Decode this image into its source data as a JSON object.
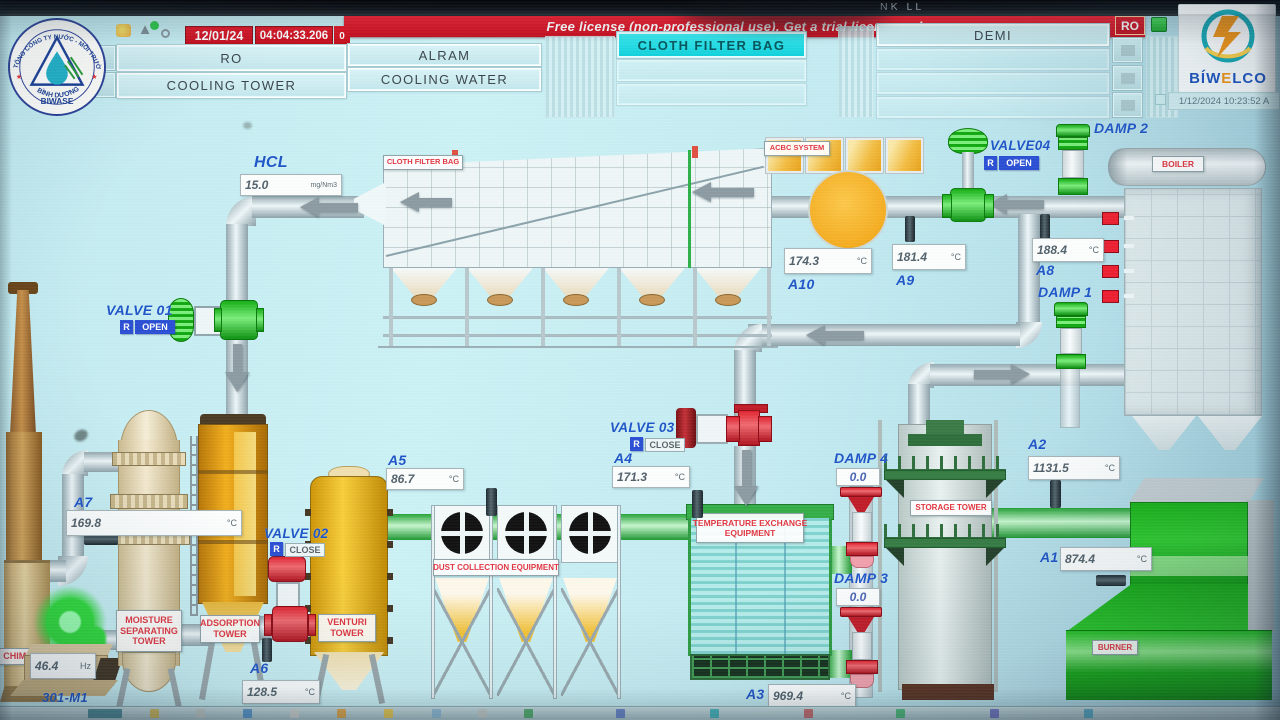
{
  "header": {
    "date": "12/01/24",
    "time": "04:04:33.206",
    "alarm_count": "0",
    "license": "Free license (non-professional use). Get a trial license or buy",
    "ro_chip": "RO",
    "bezel_text": "NK LL",
    "buttons": {
      "ro": "RO",
      "cooling_tower": "COOLING TOWER",
      "alram": "ALRAM",
      "cooling_water": "COOLING WATER",
      "cloth_filter_bag": "CLOTH FILTER BAG",
      "demi": "DEMI"
    }
  },
  "logos": {
    "biwase_arc_top": "TỔNG CÔNG TY NƯỚC - MÔI TRƯỜNG",
    "biwase_arc_bottom": "BÌNH DƯƠNG",
    "biwase_name": "BIWASE",
    "biwelco_part1": "BÍW",
    "biwelco_e": "E",
    "biwelco_part2": "LCO",
    "biwelco_datetime": "1/12/2024 10:23:52 A"
  },
  "process": {
    "hcl": {
      "label": "HCL",
      "value": "15.0",
      "unit": "mg/Nm3"
    },
    "fan": {
      "id": "301-M1",
      "value": "46.4",
      "unit": "Hz"
    },
    "sensors": {
      "a1": {
        "id": "A1",
        "value": "874.4",
        "unit": "°C"
      },
      "a2": {
        "id": "A2",
        "value": "1131.5",
        "unit": "°C"
      },
      "a3": {
        "id": "A3",
        "value": "969.4",
        "unit": "°C"
      },
      "a4": {
        "id": "A4",
        "value": "171.3",
        "unit": "°C"
      },
      "a5": {
        "id": "A5",
        "value": "86.7",
        "unit": "°C"
      },
      "a6": {
        "id": "A6",
        "value": "128.5",
        "unit": "°C"
      },
      "a7": {
        "id": "A7",
        "value": "169.8",
        "unit": "°C"
      },
      "a8": {
        "id": "A8",
        "value": "188.4",
        "unit": "°C"
      },
      "a9": {
        "id": "A9",
        "value": "181.4",
        "unit": "°C"
      },
      "a10": {
        "id": "A10",
        "value": "174.3",
        "unit": "°C"
      }
    },
    "valves": {
      "v1": {
        "label": "VALVE 01",
        "r": "R",
        "state": "OPEN"
      },
      "v2": {
        "label": "VALVE 02",
        "r": "R",
        "state": "CLOSE"
      },
      "v3": {
        "label": "VALVE 03",
        "r": "R",
        "state": "CLOSE"
      },
      "v4": {
        "label": "VALVE04",
        "r": "R",
        "state": "OPEN"
      }
    },
    "dampers": {
      "d1": {
        "label": "DAMP 1"
      },
      "d2": {
        "label": "DAMP 2"
      },
      "d3": {
        "label": "DAMP 3",
        "value": "0.0"
      },
      "d4": {
        "label": "DAMP 4",
        "value": "0.0"
      }
    },
    "equipment": {
      "cloth_filter_bag": "CLOTH FILTER BAG",
      "acbc_system": "ACBC SYSTEM",
      "boiler": "BOILER",
      "burner": "BURNER",
      "storage_tower": "STORAGE TOWER",
      "temp_exchange_line1": "TEMPERATURE EXCHANGE",
      "temp_exchange_line2": "EQUIPMENT",
      "dust_collection": "DUST COLLECTION EQUIPMENT",
      "venturi_line1": "VENTURI",
      "venturi_line2": "TOWER",
      "adsorption_line1": "ADSORPTION",
      "adsorption_line2": "TOWER",
      "moisture_line1": "MOISTURE",
      "moisture_line2": "SEPARATING",
      "moisture_line3": "TOWER",
      "chimney": "CHIMNEY"
    }
  },
  "colors": {
    "alarm_red": "#e01c2e",
    "active_cyan": "#17dde6",
    "open_green": "#1ec21e",
    "closed_red": "#d92530",
    "label_blue": "#1c55c8",
    "screen_cyan": "#c8eef3"
  }
}
